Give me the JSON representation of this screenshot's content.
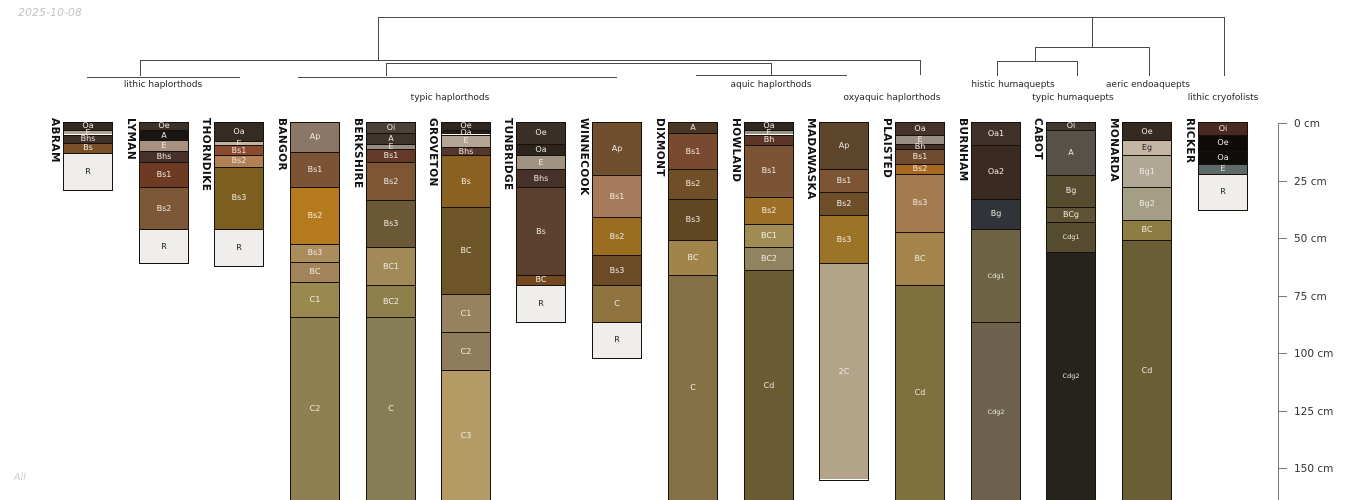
{
  "header": {
    "date": "2025-10-08",
    "footer_note": "All"
  },
  "layout": {
    "y0": 123,
    "px_per_cm": 2.3,
    "col_width": 50,
    "name_top": 118,
    "cluster_row1_y": 80,
    "cluster_row2_y": 93
  },
  "tree": {
    "color": "#4a4a4a",
    "segments": [
      {
        "x1": 378,
        "y1": 17,
        "x2": 1224,
        "y2": 17
      },
      {
        "x1": 378,
        "y1": 17,
        "x2": 378,
        "y2": 60
      },
      {
        "x1": 1092,
        "y1": 17,
        "x2": 1092,
        "y2": 47
      },
      {
        "x1": 1224,
        "y1": 17,
        "x2": 1224,
        "y2": 76
      },
      {
        "x1": 1035,
        "y1": 47,
        "x2": 1149,
        "y2": 47
      },
      {
        "x1": 1035,
        "y1": 47,
        "x2": 1035,
        "y2": 61
      },
      {
        "x1": 1149,
        "y1": 47,
        "x2": 1149,
        "y2": 76
      },
      {
        "x1": 997,
        "y1": 61,
        "x2": 1077,
        "y2": 61
      },
      {
        "x1": 997,
        "y1": 61,
        "x2": 997,
        "y2": 76
      },
      {
        "x1": 1077,
        "y1": 61,
        "x2": 1077,
        "y2": 76
      },
      {
        "x1": 140,
        "y1": 60,
        "x2": 920,
        "y2": 60
      },
      {
        "x1": 140,
        "y1": 60,
        "x2": 140,
        "y2": 76
      },
      {
        "x1": 920,
        "y1": 60,
        "x2": 920,
        "y2": 75
      },
      {
        "x1": 386,
        "y1": 62.5,
        "x2": 771,
        "y2": 62.5
      },
      {
        "x1": 386,
        "y1": 62.5,
        "x2": 386,
        "y2": 76
      },
      {
        "x1": 771,
        "y1": 62.5,
        "x2": 771,
        "y2": 74.5
      },
      {
        "x1": 87,
        "y1": 76.5,
        "x2": 240,
        "y2": 76.5
      },
      {
        "x1": 298,
        "y1": 76.5,
        "x2": 617,
        "y2": 76.5
      },
      {
        "x1": 696,
        "y1": 74.5,
        "x2": 847,
        "y2": 74.5
      }
    ]
  },
  "clusters": [
    {
      "label": "lithic haplorthods",
      "cx": 163,
      "row": 1,
      "members": [
        "ABRAM",
        "LYMAN",
        "THORNDIKE"
      ]
    },
    {
      "label": "typic haplorthods",
      "cx": 450,
      "row": 2,
      "members": [
        "BANGOR",
        "BERKSHIRE",
        "GROVETON",
        "TUNBRIDGE",
        "WINNECOOK"
      ]
    },
    {
      "label": "aquic haplorthods",
      "cx": 771,
      "row": 1,
      "members": [
        "DIXMONT",
        "HOWLAND",
        "MADAWASKA"
      ]
    },
    {
      "label": "oxyaquic haplorthods",
      "cx": 892,
      "row": 2,
      "members": [
        "PLAISTED"
      ]
    },
    {
      "label": "histic humaquepts",
      "cx": 1013,
      "row": 1,
      "members": [
        "BURNHAM"
      ]
    },
    {
      "label": "typic humaquepts",
      "cx": 1073,
      "row": 2,
      "members": [
        "CABOT"
      ]
    },
    {
      "label": "aeric endoaquepts",
      "cx": 1148,
      "row": 1,
      "members": [
        "MONARDA"
      ]
    },
    {
      "label": "lithic cryofolists",
      "cx": 1223,
      "row": 2,
      "members": [
        "RICKER"
      ]
    }
  ],
  "depth_axis": {
    "x": 1278,
    "tick_len": 9,
    "label_x": 1294,
    "line_bottom": 500,
    "unit": "cm",
    "ticks": [
      {
        "cm": 0,
        "label": "0 cm"
      },
      {
        "cm": 25,
        "label": "25 cm"
      },
      {
        "cm": 50,
        "label": "50 cm"
      },
      {
        "cm": 75,
        "label": "75 cm"
      },
      {
        "cm": 100,
        "label": "100 cm"
      },
      {
        "cm": 125,
        "label": "125 cm"
      },
      {
        "cm": 150,
        "label": "150 cm"
      }
    ]
  },
  "chart_data": {
    "type": "soil-profile-columns-with-dendrogram",
    "depth_unit": "cm",
    "depth_ticks": [
      0,
      25,
      50,
      75,
      100,
      125,
      150
    ],
    "profiles": [
      {
        "name": "ABRAM",
        "x": 63,
        "horizons": [
          {
            "label": "Oa",
            "top": 0,
            "bottom": 3,
            "color": "#332a22"
          },
          {
            "label": "E",
            "top": 3,
            "bottom": 5,
            "color": "#b3a393"
          },
          {
            "label": "Bhs",
            "top": 5,
            "bottom": 8.5,
            "color": "#3f2f26"
          },
          {
            "label": "Bs",
            "top": 8.5,
            "bottom": 13,
            "color": "#7a4f28"
          },
          {
            "label": "R",
            "top": 13,
            "bottom": 29,
            "color": "#efeeec",
            "text": "dark"
          }
        ]
      },
      {
        "name": "LYMAN",
        "x": 139,
        "horizons": [
          {
            "label": "Oe",
            "top": 0,
            "bottom": 3,
            "color": "#3a322a"
          },
          {
            "label": "A",
            "top": 3,
            "bottom": 7.5,
            "color": "#191512"
          },
          {
            "label": "E",
            "top": 7.5,
            "bottom": 12,
            "color": "#a8917f"
          },
          {
            "label": "Bhs",
            "top": 12,
            "bottom": 17,
            "color": "#463229"
          },
          {
            "label": "Bs1",
            "top": 17,
            "bottom": 28,
            "color": "#6e3a23"
          },
          {
            "label": "Bs2",
            "top": 28,
            "bottom": 46,
            "color": "#7c5837"
          },
          {
            "label": "R",
            "top": 46,
            "bottom": 61,
            "color": "#efeeec",
            "text": "dark"
          }
        ]
      },
      {
        "name": "THORNDIKE",
        "x": 214,
        "horizons": [
          {
            "label": "Oa",
            "top": 0,
            "bottom": 8,
            "color": "#342b23"
          },
          {
            "label": "E",
            "top": 8,
            "bottom": 9.5,
            "color": "#c2b3a5"
          },
          {
            "label": "Bs1",
            "top": 9.5,
            "bottom": 14,
            "color": "#8a4a2d"
          },
          {
            "label": "Bs2",
            "top": 14,
            "bottom": 19,
            "color": "#b28055"
          },
          {
            "label": "Bs3",
            "top": 19,
            "bottom": 46,
            "color": "#7c5f1f"
          },
          {
            "label": "R",
            "top": 46,
            "bottom": 62,
            "color": "#efeeec",
            "text": "dark"
          }
        ]
      },
      {
        "name": "BANGOR",
        "x": 290,
        "horizons": [
          {
            "label": "Ap",
            "top": 0,
            "bottom": 12.5,
            "color": "#8a7765"
          },
          {
            "label": "Bs1",
            "top": 12.5,
            "bottom": 28,
            "color": "#7a5435"
          },
          {
            "label": "Bs2",
            "top": 28,
            "bottom": 52.5,
            "color": "#b5791e"
          },
          {
            "label": "Bs3",
            "top": 52.5,
            "bottom": 60.5,
            "color": "#ab8d5c"
          },
          {
            "label": "BC",
            "top": 60.5,
            "bottom": 69,
            "color": "#a3845a"
          },
          {
            "label": "C1",
            "top": 69,
            "bottom": 84.5,
            "color": "#99884f"
          },
          {
            "label": "C2",
            "top": 84.5,
            "bottom": 164,
            "color": "#8e8050"
          }
        ]
      },
      {
        "name": "BERKSHIRE",
        "x": 366,
        "horizons": [
          {
            "label": "Oi",
            "top": 0,
            "bottom": 4.5,
            "color": "#4a423a"
          },
          {
            "label": "A",
            "top": 4.5,
            "bottom": 9,
            "color": "#3d342c"
          },
          {
            "label": "E",
            "top": 9,
            "bottom": 11.5,
            "color": "#958d83"
          },
          {
            "label": "Bs1",
            "top": 11.5,
            "bottom": 17,
            "color": "#64392a"
          },
          {
            "label": "Bs2",
            "top": 17,
            "bottom": 33.5,
            "color": "#7d5634"
          },
          {
            "label": "Bs3",
            "top": 33.5,
            "bottom": 54,
            "color": "#6b5837"
          },
          {
            "label": "BC1",
            "top": 54,
            "bottom": 70.5,
            "color": "#a18a58"
          },
          {
            "label": "BC2",
            "top": 70.5,
            "bottom": 84.5,
            "color": "#8f7f4a"
          },
          {
            "label": "C",
            "top": 84.5,
            "bottom": 164,
            "color": "#867d56"
          }
        ]
      },
      {
        "name": "GROVETON",
        "x": 441,
        "horizons": [
          {
            "label": "Oe",
            "top": 0,
            "bottom": 3,
            "color": "#2e2620"
          },
          {
            "label": "Oa",
            "top": 3,
            "bottom": 5,
            "color": "#221c17"
          },
          {
            "label": "E",
            "top": 5,
            "bottom": 10.5,
            "color": "#b3a695"
          },
          {
            "label": "Bhs",
            "top": 10.5,
            "bottom": 14,
            "color": "#55362a"
          },
          {
            "label": "Bs",
            "top": 14,
            "bottom": 36.5,
            "color": "#8a611e"
          },
          {
            "label": "BC",
            "top": 36.5,
            "bottom": 74.5,
            "color": "#6d5528"
          },
          {
            "label": "C1",
            "top": 74.5,
            "bottom": 91,
            "color": "#97825f"
          },
          {
            "label": "C2",
            "top": 91,
            "bottom": 107.5,
            "color": "#8f7c5c"
          },
          {
            "label": "C3",
            "top": 107.5,
            "bottom": 164,
            "color": "#b49a64"
          }
        ]
      },
      {
        "name": "TUNBRIDGE",
        "x": 516,
        "horizons": [
          {
            "label": "Oe",
            "top": 0,
            "bottom": 9,
            "color": "#3a3027"
          },
          {
            "label": "Oa",
            "top": 9,
            "bottom": 14,
            "color": "#2c241d"
          },
          {
            "label": "E",
            "top": 14,
            "bottom": 20,
            "color": "#a09382"
          },
          {
            "label": "Bhs",
            "top": 20,
            "bottom": 28,
            "color": "#463228"
          },
          {
            "label": "Bs",
            "top": 28,
            "bottom": 66,
            "color": "#5d4130"
          },
          {
            "label": "BC",
            "top": 66,
            "bottom": 70.5,
            "color": "#74491f"
          },
          {
            "label": "R",
            "top": 70.5,
            "bottom": 86.5,
            "color": "#efeeec",
            "text": "dark"
          }
        ]
      },
      {
        "name": "WINNECOOK",
        "x": 592,
        "horizons": [
          {
            "label": "Ap",
            "top": 0,
            "bottom": 22.5,
            "color": "#6f4f2e"
          },
          {
            "label": "Bs1",
            "top": 22.5,
            "bottom": 41,
            "color": "#a5795a"
          },
          {
            "label": "Bs2",
            "top": 41,
            "bottom": 57.5,
            "color": "#9a6d21"
          },
          {
            "label": "Bs3",
            "top": 57.5,
            "bottom": 70.5,
            "color": "#6b4a26"
          },
          {
            "label": "C",
            "top": 70.5,
            "bottom": 86.5,
            "color": "#8f7440"
          },
          {
            "label": "R",
            "top": 86.5,
            "bottom": 102,
            "color": "#efeeec",
            "text": "dark"
          }
        ]
      },
      {
        "name": "DIXMONT",
        "x": 668,
        "horizons": [
          {
            "label": "A",
            "top": 0,
            "bottom": 4.5,
            "color": "#4a3825"
          },
          {
            "label": "Bs1",
            "top": 4.5,
            "bottom": 20,
            "color": "#7a4a30"
          },
          {
            "label": "Bs2",
            "top": 20,
            "bottom": 33,
            "color": "#6f4e28"
          },
          {
            "label": "Bs3",
            "top": 33,
            "bottom": 51,
            "color": "#5f4722"
          },
          {
            "label": "BC",
            "top": 51,
            "bottom": 66,
            "color": "#a08449"
          },
          {
            "label": "C",
            "top": 66,
            "bottom": 164,
            "color": "#857146"
          }
        ]
      },
      {
        "name": "HOWLAND",
        "x": 744,
        "horizons": [
          {
            "label": "Oa",
            "top": 0,
            "bottom": 3,
            "color": "#2e2721"
          },
          {
            "label": "E",
            "top": 3,
            "bottom": 5,
            "color": "#9b9186"
          },
          {
            "label": "Bh",
            "top": 5,
            "bottom": 9.5,
            "color": "#5d3527"
          },
          {
            "label": "Bs1",
            "top": 9.5,
            "bottom": 32,
            "color": "#7b5335"
          },
          {
            "label": "Bs2",
            "top": 32,
            "bottom": 44,
            "color": "#9c6f26"
          },
          {
            "label": "BC1",
            "top": 44,
            "bottom": 54,
            "color": "#a18b55"
          },
          {
            "label": "BC2",
            "top": 54,
            "bottom": 64,
            "color": "#90835f"
          },
          {
            "label": "Cd",
            "top": 64,
            "bottom": 164,
            "color": "#6a5b33"
          }
        ]
      },
      {
        "name": "MADAWASKA",
        "x": 819,
        "horizons": [
          {
            "label": "Ap",
            "top": 0,
            "bottom": 20,
            "color": "#5c452a"
          },
          {
            "label": "Bs1",
            "top": 20,
            "bottom": 30,
            "color": "#7d5534"
          },
          {
            "label": "Bs2",
            "top": 30,
            "bottom": 40,
            "color": "#6f4f2a"
          },
          {
            "label": "Bs3",
            "top": 40,
            "bottom": 61,
            "color": "#9c7427"
          },
          {
            "label": "2C",
            "top": 61,
            "bottom": 155,
            "color": "#b3a489"
          }
        ]
      },
      {
        "name": "PLAISTED",
        "x": 895,
        "horizons": [
          {
            "label": "Oa",
            "top": 0,
            "bottom": 5,
            "color": "#453228"
          },
          {
            "label": "E",
            "top": 5,
            "bottom": 9,
            "color": "#988f82"
          },
          {
            "label": "Bh",
            "top": 9,
            "bottom": 11.5,
            "color": "#42302a"
          },
          {
            "label": "Bs1",
            "top": 11.5,
            "bottom": 18,
            "color": "#6f4a2c"
          },
          {
            "label": "Bs2",
            "top": 18,
            "bottom": 22,
            "color": "#a9681f"
          },
          {
            "label": "Bs3",
            "top": 22,
            "bottom": 47.5,
            "color": "#a37b4e"
          },
          {
            "label": "BC",
            "top": 47.5,
            "bottom": 70.5,
            "color": "#a3854b"
          },
          {
            "label": "Cd",
            "top": 70.5,
            "bottom": 164,
            "color": "#80703d"
          }
        ]
      },
      {
        "name": "BURNHAM",
        "x": 971,
        "horizons": [
          {
            "label": "Oa1",
            "top": 0,
            "bottom": 9.5,
            "color": "#40302a"
          },
          {
            "label": "Oa2",
            "top": 9.5,
            "bottom": 33,
            "color": "#3a2a22"
          },
          {
            "label": "Bg",
            "top": 33,
            "bottom": 46,
            "color": "#303339"
          },
          {
            "label": "Cdg1",
            "top": 46,
            "bottom": 86.5,
            "color": "#6d6446",
            "small": true
          },
          {
            "label": "Cdg2",
            "top": 86.5,
            "bottom": 164,
            "color": "#6c624d",
            "small": true
          }
        ]
      },
      {
        "name": "CABOT",
        "x": 1046,
        "horizons": [
          {
            "label": "Oi",
            "top": 0,
            "bottom": 3,
            "color": "#3f382e"
          },
          {
            "label": "A",
            "top": 3,
            "bottom": 22.5,
            "color": "#57514a"
          },
          {
            "label": "Bg",
            "top": 22.5,
            "bottom": 36.5,
            "color": "#564c30"
          },
          {
            "label": "BCg",
            "top": 36.5,
            "bottom": 43,
            "color": "#5d5334"
          },
          {
            "label": "Cdg1",
            "top": 43,
            "bottom": 56,
            "color": "#554c30",
            "small": true
          },
          {
            "label": "Cdg2",
            "top": 56,
            "bottom": 164,
            "color": "#26231e",
            "small": true
          }
        ]
      },
      {
        "name": "MONARDA",
        "x": 1122,
        "horizons": [
          {
            "label": "Oe",
            "top": 0,
            "bottom": 7.5,
            "color": "#342a22"
          },
          {
            "label": "Eg",
            "top": 7.5,
            "bottom": 14,
            "color": "#c5b5a3",
            "text": "dark"
          },
          {
            "label": "Bg1",
            "top": 14,
            "bottom": 28,
            "color": "#b0a794"
          },
          {
            "label": "Bg2",
            "top": 28,
            "bottom": 42,
            "color": "#a49e85"
          },
          {
            "label": "BC",
            "top": 42,
            "bottom": 51,
            "color": "#8d7d42"
          },
          {
            "label": "Cd",
            "top": 51,
            "bottom": 164,
            "color": "#6b5d35"
          }
        ]
      },
      {
        "name": "RICKER",
        "x": 1198,
        "horizons": [
          {
            "label": "Oi",
            "top": 0,
            "bottom": 5,
            "color": "#4a2a20"
          },
          {
            "label": "Oe",
            "top": 5,
            "bottom": 12,
            "color": "#0d0b09"
          },
          {
            "label": "Oa",
            "top": 12,
            "bottom": 18,
            "color": "#0f0d0a"
          },
          {
            "label": "E",
            "top": 18,
            "bottom": 22,
            "color": "#5c6a6a"
          },
          {
            "label": "R",
            "top": 22,
            "bottom": 38,
            "color": "#efeeec",
            "text": "dark"
          }
        ]
      }
    ]
  }
}
